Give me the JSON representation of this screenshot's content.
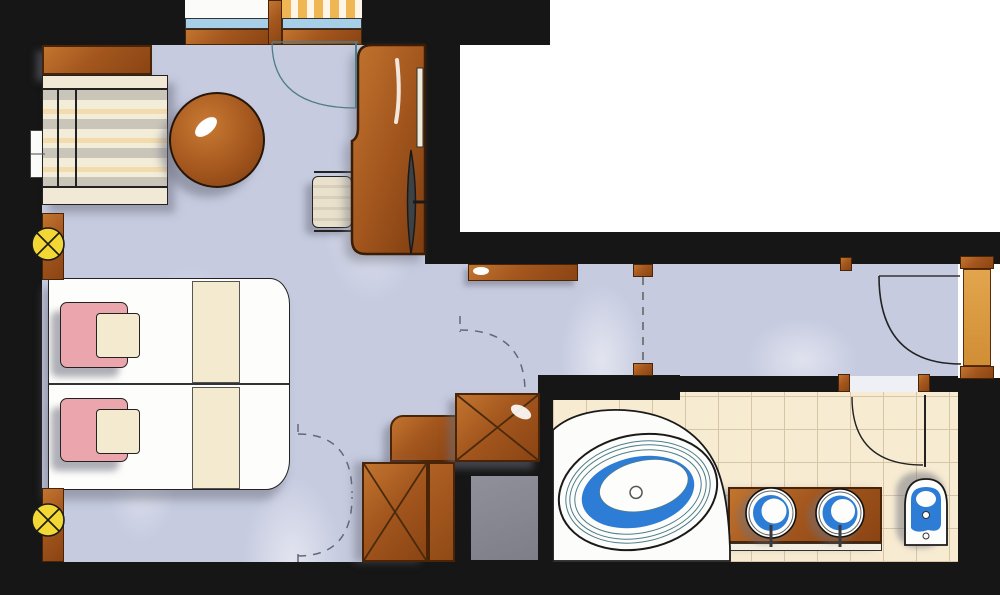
{
  "document": {
    "type": "hand-drawn hotel room floor plan",
    "style": "marker rendering",
    "visible_text": "none"
  },
  "palette": {
    "wall_black": "#161616",
    "carpet_lavender": "#c6cbe0",
    "wood_brown": "#a4571e",
    "wood_dark_outline": "#4a2406",
    "tile_beige": "#f7ebd2",
    "tile_grout": "#d6c5a6",
    "water_blue": "#2d7cd6",
    "glass_blue": "#a8cfe8",
    "lamp_yellow": "#f2d735",
    "headrest_pink": "#eba6ad",
    "bed_cream": "#f3ead0",
    "entry_door_orange": "#dc9a3e",
    "door_line_teal": "#4d7d8a",
    "shadow_gray": "#787c8c"
  },
  "rooms": [
    {
      "name": "bedroom",
      "floor": "carpet_lavender",
      "items": [
        "console-shelf",
        "striped-bench-sofa",
        "round-side-table",
        "double-bed",
        "bed-runner-top",
        "bed-runner-bottom",
        "pink-headrest-top",
        "pink-headrest-bottom",
        "desk",
        "desk-chair",
        "tv-screen",
        "desk-wall-shelf",
        "wall-light-upper",
        "wall-light-lower",
        "left-wall-window",
        "balcony-window",
        "balcony-door-swing"
      ]
    },
    {
      "name": "dressing-area",
      "floor": "carpet_lavender",
      "items": [
        "wardrobe-x-upper",
        "wardrobe-corner-unit",
        "wardrobe-x-lower",
        "wardrobe-side-panel",
        "bifold-door-dashed-top",
        "bifold-door-dashed-bottom",
        "dressing-door-dashed",
        "service-shaft"
      ]
    },
    {
      "name": "entry-corridor",
      "floor": "carpet_lavender",
      "items": [
        "corridor-console",
        "passage-dashed-line",
        "entry-door-leaf",
        "entry-door-swing"
      ]
    },
    {
      "name": "bathroom",
      "floor": "tile_beige",
      "items": [
        "tub-platform",
        "oval-bathtub",
        "vanity-counter",
        "round-basin-left",
        "round-basin-right",
        "basin-faucet-left",
        "basin-faucet-right",
        "toilet-bidet",
        "bathroom-door-swing"
      ]
    }
  ],
  "legend": [
    {
      "symbol": "circle-with-x",
      "meaning": "wall light point",
      "count": 2
    },
    {
      "symbol": "square-with-x",
      "meaning": "wardrobe / closet unit",
      "count": 2
    },
    {
      "symbol": "dashed-arc",
      "meaning": "folding / sliding door swing",
      "count": 3
    },
    {
      "symbol": "solid-arc",
      "meaning": "hinged door swing",
      "count": 3
    },
    {
      "symbol": "blue-strip",
      "meaning": "window glazing",
      "count": 2
    }
  ],
  "counts": {
    "beds": 1,
    "headrests": 2,
    "basins": 2,
    "bathtubs": 1,
    "toilets": 1,
    "wardrobes": 2,
    "doors": 6
  }
}
